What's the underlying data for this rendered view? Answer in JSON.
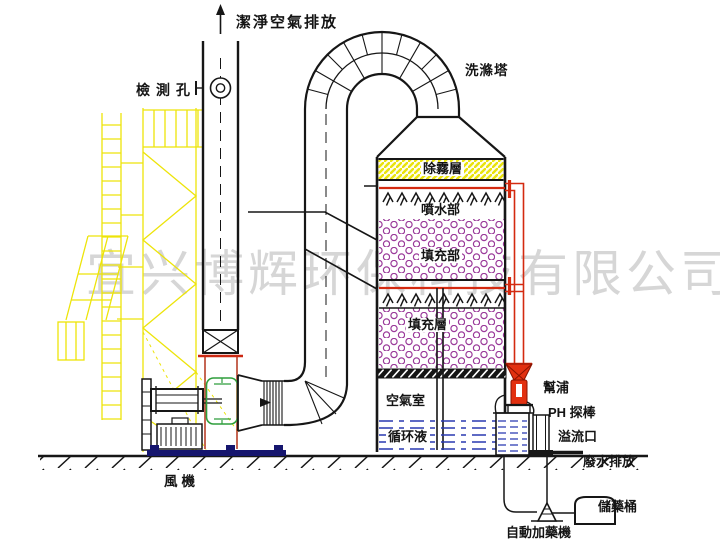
{
  "diagram": {
    "watermark": "宜兴博辉环保科技有限公司",
    "labels": {
      "clean_air_outlet": "潔淨空氣排放",
      "inspection_port": "檢測孔",
      "scrubber_tower": "洗滌塔",
      "demister_layer": "除霧層",
      "spray_section": "噴水部",
      "packing_section": "填充部",
      "packing_layer": "填充層",
      "air_chamber": "空氣室",
      "circulating_liquid": "循环液",
      "fan": "風機",
      "pump": "幫浦",
      "ph_probe": "PH 探棒",
      "overflow_port": "溢流口",
      "wastewater_discharge": "廢水排放",
      "chemical_storage_barrel": "儲藥桶",
      "auto_dosing_machine": "自動加藥機"
    },
    "colors": {
      "line_black": "#161616",
      "scaffold_yellow": "#ede409",
      "pipe_red": "#d42a10",
      "fan_green": "#2f9e3c",
      "water_blue": "#2838b0",
      "packing_purple": "#9a3a9a",
      "base_navy": "#15156e",
      "watermark_gray": "#d6d6d6"
    }
  }
}
